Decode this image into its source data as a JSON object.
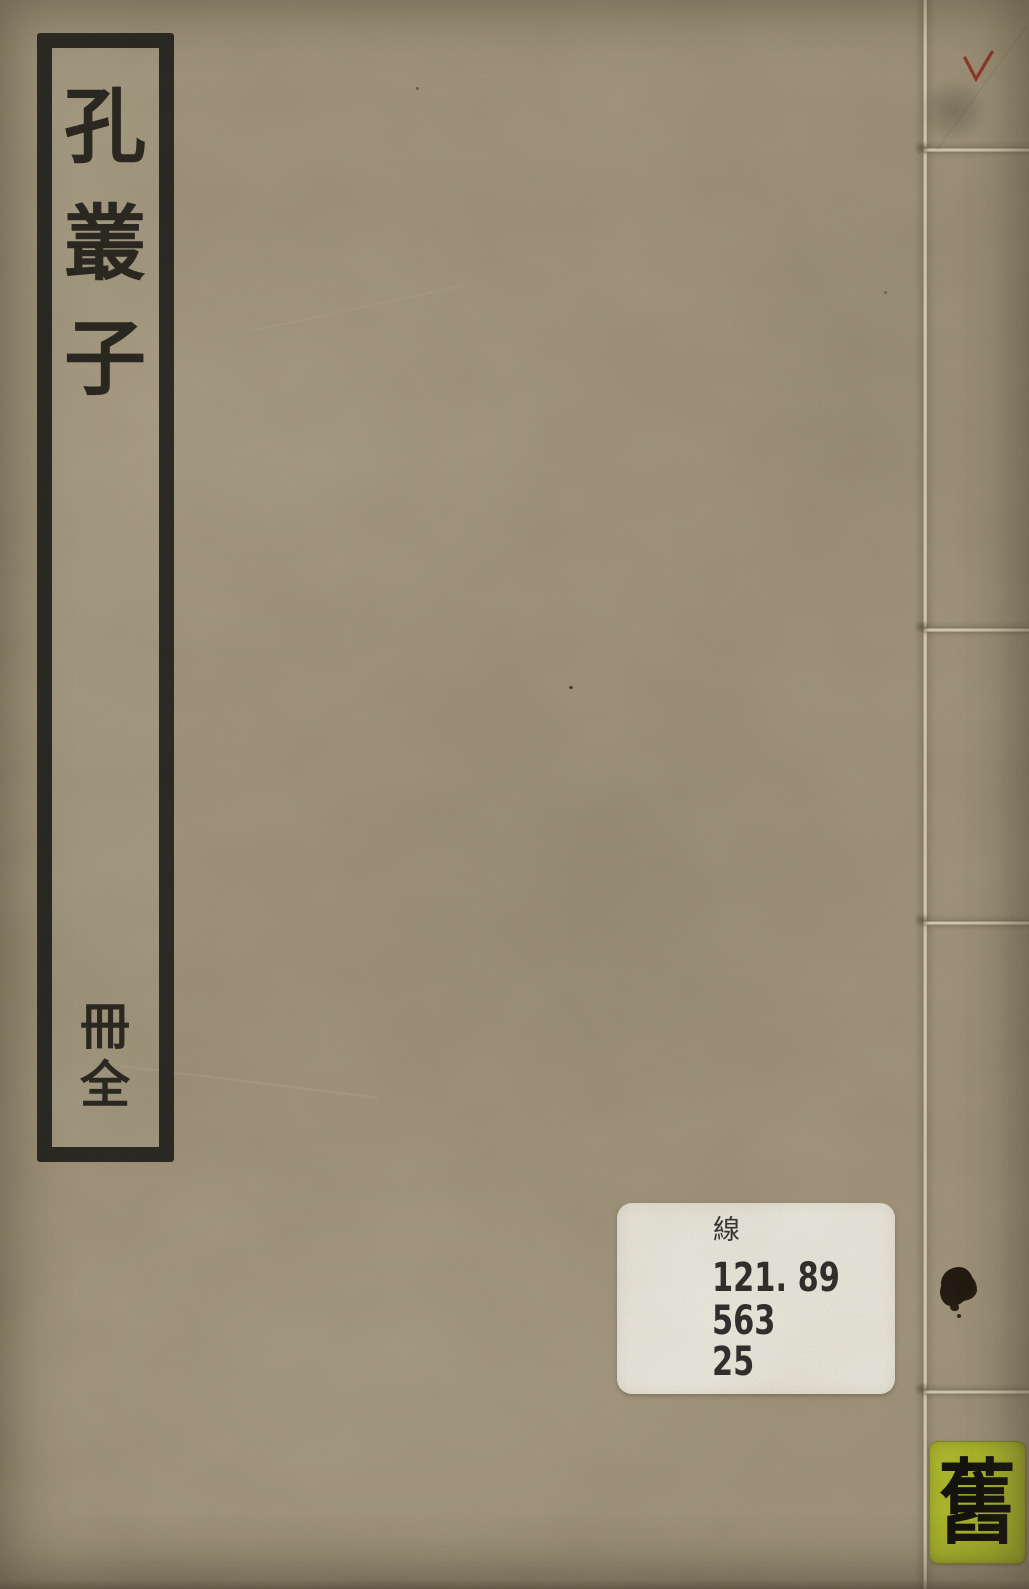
{
  "book_cover": {
    "title_label": {
      "title_text": "孔叢子",
      "title_chars": [
        "孔",
        "叢",
        "子"
      ],
      "volume_text": "冊全",
      "volume_chars": [
        "冊",
        "全"
      ]
    },
    "library_label": {
      "category_char": "線",
      "call_number": "121. 89",
      "line2": "563",
      "line3": "25"
    },
    "condition_label": {
      "char": "舊"
    },
    "marks": {
      "red_check_icon": "check-mark",
      "smudge_icon": "smudge-stain",
      "ink_blot_icon": "ink-stain"
    },
    "colors": {
      "paper": "#a79b83",
      "frame_ink": "#2e2c27",
      "character_ink": "#2d2a24",
      "library_label_bg": "#f2f0e8",
      "condition_label_bg": "#b5c130",
      "check_red": "#9b2d24",
      "thread_light": "#ecdfc5"
    }
  }
}
